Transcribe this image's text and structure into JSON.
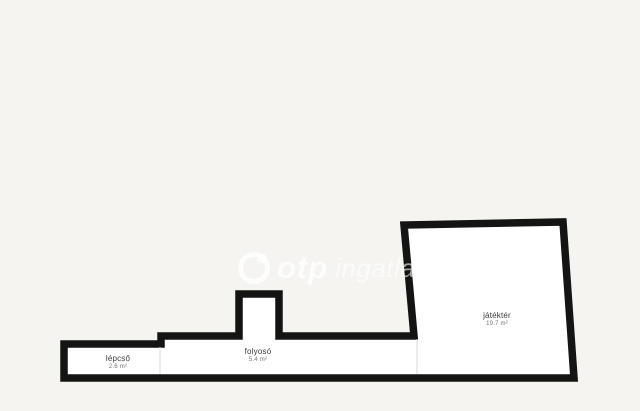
{
  "watermark": {
    "brand": "otp",
    "suffix": "ingatlanpont"
  },
  "rooms": [
    {
      "name": "lépcső",
      "area": "2.6 m²"
    },
    {
      "name": "folyosó",
      "area": "5.4 m²"
    },
    {
      "name": "játéktér",
      "area": "19.7 m²"
    }
  ],
  "colors": {
    "background": "#f5f4f1",
    "wall": "#141414",
    "floor": "#ffffff",
    "divider": "#dcdad6",
    "room_name": "#3b3b3b",
    "room_area": "#767472",
    "watermark": "#ffffff"
  }
}
